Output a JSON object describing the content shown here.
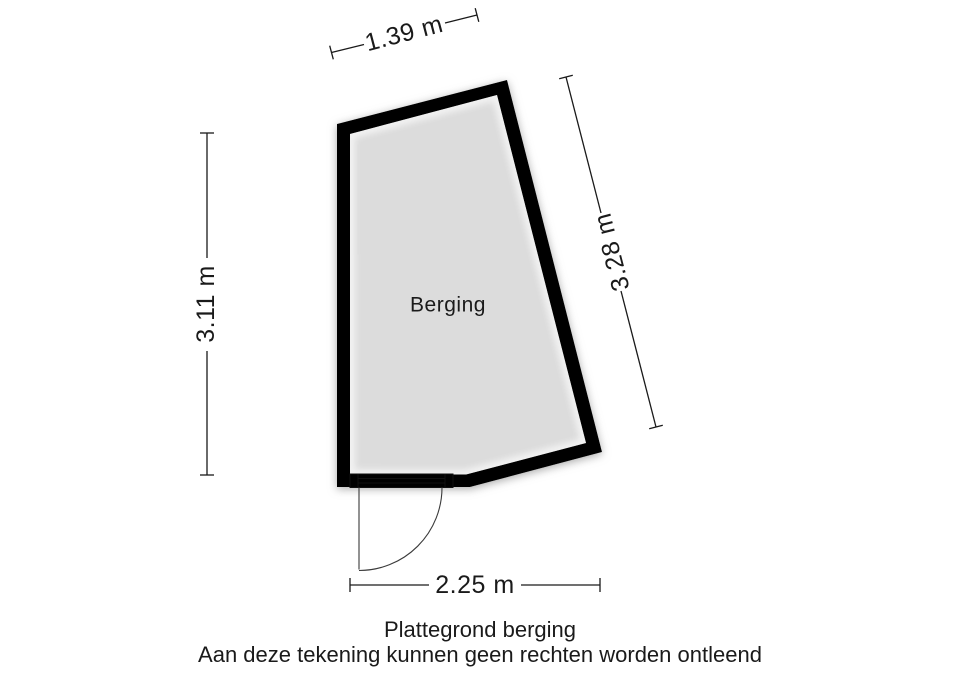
{
  "plan": {
    "room": {
      "label": "Berging",
      "floor_color": "#dcdcdc",
      "wall_color": "#000000"
    },
    "dimensions": {
      "top": "1.39 m",
      "left": "3.11 m",
      "right": "3.28 m",
      "bottom": "2.25 m"
    },
    "caption": {
      "title": "Plattegrond berging",
      "disclaimer": "Aan deze tekening kunnen geen rechten worden ontleend"
    }
  }
}
